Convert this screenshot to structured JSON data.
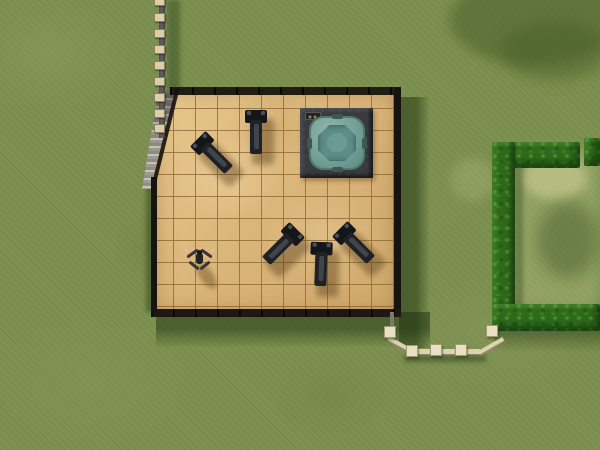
{
  "meta": {
    "app": "life-simulation game (The Sims 2)",
    "view": "top-down lot view",
    "description": "Top-down view of a lot: an outdoor gym patio with tan tile floor containing five black exercise benches, a teal hot tub on a dark platform, and a sim doing jumping jacks; concrete stairs and a post fence on the left, a picket path fence at lower right leading to a dark green hedge enclosure over mottled grass."
  },
  "colors": {
    "grass": "#7d9150",
    "grout": "rgba(148,110,58,0.85)",
    "floor-hi": "#e8c98e",
    "floor-lo": "#d8b277",
    "wall": "#17130e",
    "hedge": "#2f6a1c",
    "fence-rail": "#63635d",
    "fence-post": "#dbcfaa",
    "path-fence": "#ddd3b2",
    "tub-platform": "#3a3b40",
    "tub-shell": "#74a096",
    "tub-water": "#5d8d89",
    "bench-dark": "#15161a",
    "bench-mid": "#1f2126"
  },
  "scene": {
    "ground": {
      "label": "grass lawn"
    },
    "building": {
      "label": "gym room",
      "floor_label": "tan tile floor",
      "wall_label": "dark walls"
    },
    "objects": {
      "hot_tub": {
        "label": "hot tub on platform"
      },
      "sim": {
        "label": "sim doing jumping jacks"
      },
      "stairs": {
        "label": "concrete stairs"
      },
      "hedge": {
        "label": "hedge enclosure"
      },
      "benches": {
        "label": "exercise bench",
        "items": [
          {
            "cx": 214,
            "cy": 155,
            "rot": -45
          },
          {
            "cx": 256,
            "cy": 133,
            "rot": 0
          },
          {
            "cx": 281,
            "cy": 246,
            "rot": 45
          },
          {
            "cx": 321,
            "cy": 265,
            "rot": 2
          },
          {
            "cx": 356,
            "cy": 245,
            "rot": -45
          }
        ]
      },
      "left_fence": {
        "label": "rail fence",
        "post_ys": [
          -3,
          13,
          29,
          45,
          61,
          77,
          93,
          109,
          124
        ]
      },
      "path_fence": {
        "label": "picket fence",
        "posts": [
          {
            "x": 384,
            "y": 326
          },
          {
            "x": 406,
            "y": 345
          },
          {
            "x": 430,
            "y": 344
          },
          {
            "x": 455,
            "y": 344
          },
          {
            "x": 486,
            "y": 325
          }
        ]
      }
    }
  }
}
